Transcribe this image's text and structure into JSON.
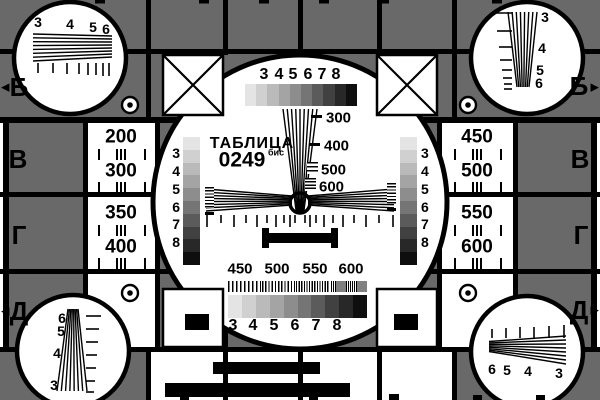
{
  "palette": {
    "background_gray": "#696969",
    "ink_black": "#000000",
    "paper_white": "#ffffff",
    "gray_steps": [
      "#e4e4e4",
      "#d0d0d0",
      "#bababa",
      "#a4a4a4",
      "#8d8d8d",
      "#757575",
      "#5b5b5b",
      "#414141",
      "#282828",
      "#0e0e0e"
    ]
  },
  "title": {
    "name": "ТАБЛИЦА",
    "code": "0249",
    "code_suffix": "бис"
  },
  "row_letters": {
    "b_left": "Б",
    "b_right": "Б",
    "v_left": "В",
    "v_right": "В",
    "g_left": "Г",
    "g_right": "Г",
    "d_left": "Д",
    "d_right": "Д"
  },
  "arrows": {
    "left": "◀",
    "right": "▶"
  },
  "center_circle": {
    "top_scale": [
      "3",
      "4",
      "5",
      "6",
      "7",
      "8"
    ],
    "vertical_wedge_marks": [
      "300",
      "400",
      "500",
      "600"
    ],
    "left_strip_scale": [
      "3",
      "4",
      "5",
      "6",
      "7",
      "8"
    ],
    "right_strip_scale": [
      "3",
      "4",
      "5",
      "6",
      "7",
      "8"
    ],
    "bottom_freq_marks": [
      "450",
      "500",
      "550",
      "600"
    ],
    "bottom_scale": [
      "3",
      "4",
      "5",
      "6",
      "7",
      "8"
    ]
  },
  "side_cells": {
    "left_top": [
      "200",
      "300"
    ],
    "left_bottom": [
      "350",
      "400"
    ],
    "right_top": [
      "450",
      "500"
    ],
    "right_bottom": [
      "550",
      "600"
    ]
  },
  "corner_circles": {
    "top_left": [
      "3",
      "4",
      "5",
      "6"
    ],
    "top_right": [
      "3",
      "4",
      "5",
      "6"
    ],
    "bottom_left": [
      "6",
      "5",
      "4",
      "3"
    ],
    "bottom_right": [
      "6",
      "5",
      "4",
      "3"
    ]
  }
}
